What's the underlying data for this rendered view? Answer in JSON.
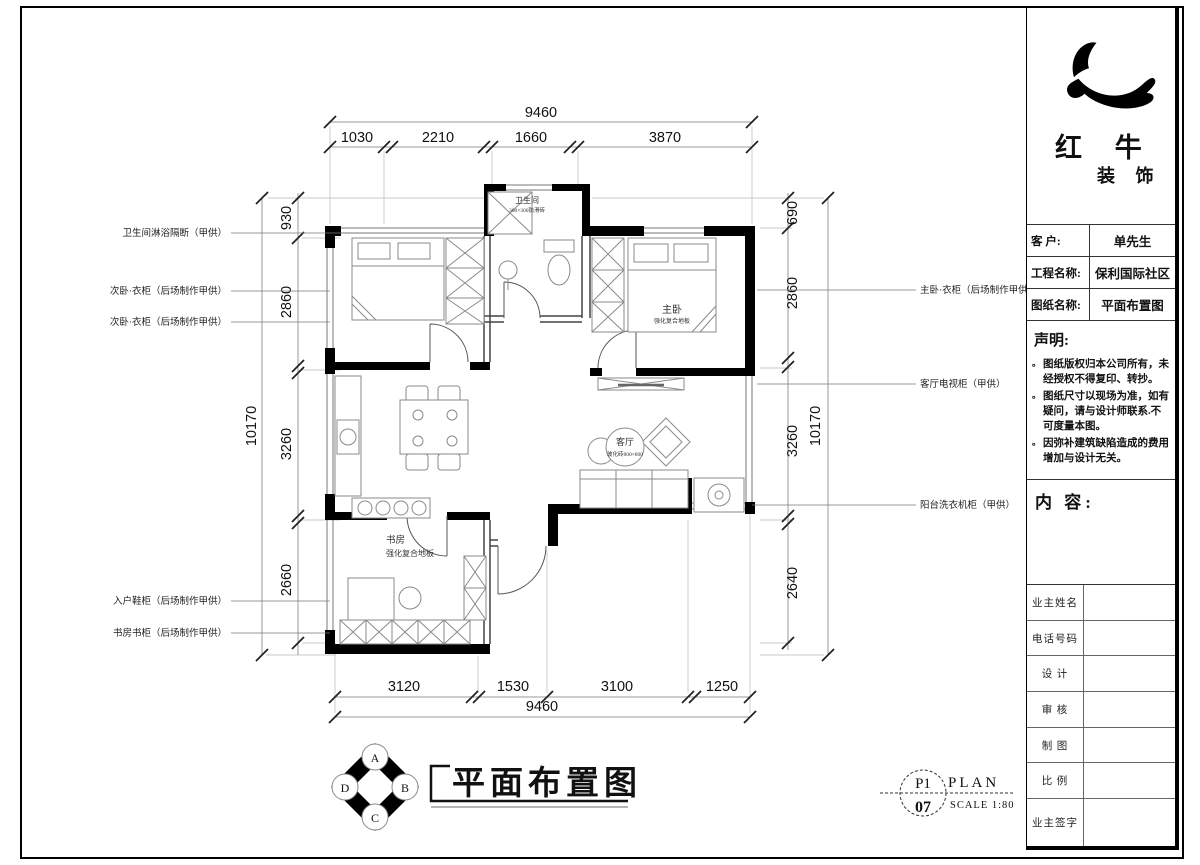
{
  "title_block": {
    "brand": {
      "name_cn": "红 牛",
      "suffix_cn": "装 饰"
    },
    "info": {
      "rows": [
        {
          "label": "客  户:",
          "value": "单先生"
        },
        {
          "label": "工程名称:",
          "value": "保利国际社区"
        },
        {
          "label": "图纸名称:",
          "value": "平面布置图"
        }
      ]
    },
    "statement": {
      "heading": "声明:",
      "items": [
        "图纸版权归本公司所有，未经授权不得复印、转抄。",
        "图纸尺寸以现场为准，如有疑问，请与设计师联系.不可度量本图。",
        "因弥补建筑缺陷造成的费用增加与设计无关。"
      ]
    },
    "content": {
      "heading": "内 容:"
    },
    "signature": {
      "rows": [
        "业主姓名",
        "电话号码",
        "设 计",
        "审 核",
        "制 图",
        "比 例",
        "业主签字"
      ]
    }
  },
  "drawing": {
    "title": "平面布置图",
    "sheet": {
      "page": "P1",
      "number": "07",
      "type_label": "PLAN",
      "scale_label": "SCALE 1:80"
    },
    "compass": {
      "a": "A",
      "b": "B",
      "c": "C",
      "d": "D"
    },
    "dims": {
      "top": {
        "overall": "9460",
        "seg1": "1030",
        "seg2": "2210",
        "seg3": "1660",
        "seg4": "3870"
      },
      "bottom": {
        "overall": "9460",
        "seg1": "3120",
        "seg2": "1530",
        "seg3": "3100",
        "seg4": "1250"
      },
      "left": {
        "overall": "10170",
        "seg1": "930",
        "seg2": "2860",
        "seg3": "3260",
        "seg4": "2660"
      },
      "right": {
        "overall": "10170",
        "seg1": "690",
        "seg2": "2860",
        "seg3": "3260",
        "seg4": "2640"
      }
    },
    "rooms": {
      "bathroom": {
        "name": "卫生间",
        "finish": "300×300防滑砖"
      },
      "master": {
        "name": "主卧",
        "finish": "强化复合地板"
      },
      "living": {
        "name": "客厅",
        "finish": "玻化砖800×800"
      },
      "study": {
        "name": "书房",
        "finish": "强化复合地板"
      }
    },
    "callouts": {
      "left": [
        "卫生间淋浴隔断（甲供）",
        "次卧·衣柜（后场制作甲供）",
        "次卧·衣柜（后场制作甲供）",
        "入户鞋柜（后场制作甲供）",
        "书房书柜（后场制作甲供）"
      ],
      "right": [
        "主卧·衣柜（后场制作甲供）",
        "客厅电视柜（甲供）",
        "阳台洗衣机柜（甲供）"
      ]
    }
  }
}
